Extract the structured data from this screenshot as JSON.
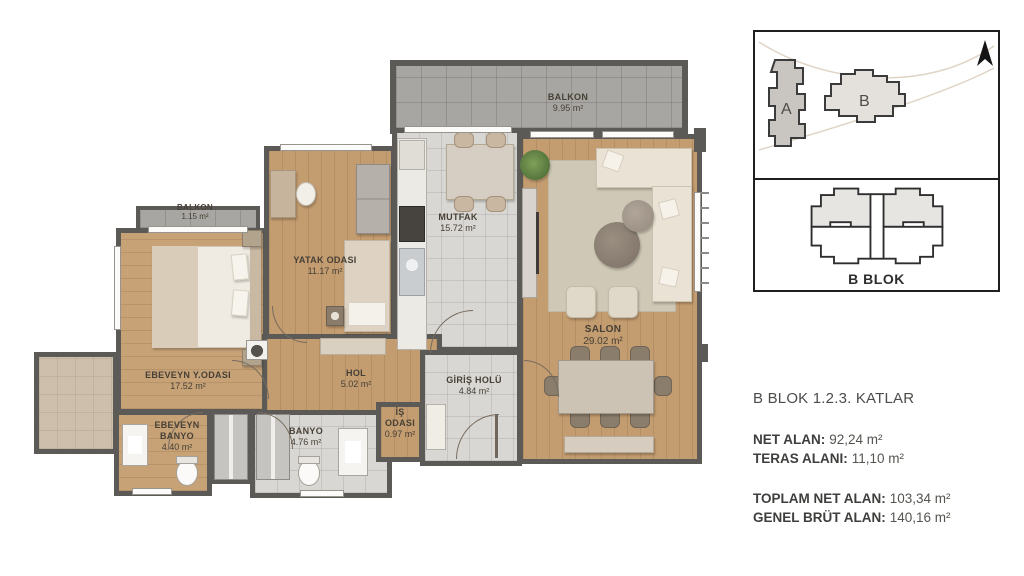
{
  "plan": {
    "rooms": [
      {
        "name": "BALKON",
        "area": "9.95 m²"
      },
      {
        "name": "BALKON",
        "area": "1.15 m²"
      },
      {
        "name": "YATAK ODASI",
        "area": "11.17 m²"
      },
      {
        "name": "MUTFAK",
        "area": "15.72 m²"
      },
      {
        "name": "SALON",
        "area": "29.02 m²"
      },
      {
        "name": "EBEVEYN Y.ODASI",
        "area": "17.52 m²"
      },
      {
        "name": "HOL",
        "area": "5.02 m²"
      },
      {
        "name": "GİRİŞ HOLÜ",
        "area": "4.84 m²"
      },
      {
        "name": "EBEVEYN\nBANYO",
        "area": "4.40 m²"
      },
      {
        "name": "BANYO",
        "area": "4.76 m²"
      },
      {
        "name": "İŞ\nODASI",
        "area": "0.97 m²"
      }
    ]
  },
  "inset": {
    "site": {
      "a": "A",
      "b": "B"
    },
    "block_label": "B BLOK"
  },
  "info": {
    "title": "B BLOK 1.2.3. KATLAR",
    "group1": [
      {
        "label": "NET ALAN:",
        "value": "92,24 m²"
      },
      {
        "label": "TERAS ALANI:",
        "value": "11,10 m²"
      }
    ],
    "group2": [
      {
        "label": "TOPLAM NET ALAN:",
        "value": "103,34 m²"
      },
      {
        "label": "GENEL BRÜT ALAN:",
        "value": "140,16 m²"
      }
    ]
  },
  "colors": {
    "wall": "#5b5a57",
    "wood_floor": "#c39c70",
    "tile_floor": "#d9d7d3",
    "balcony_tile": "#a8a6a2",
    "label_text": "#464036"
  }
}
